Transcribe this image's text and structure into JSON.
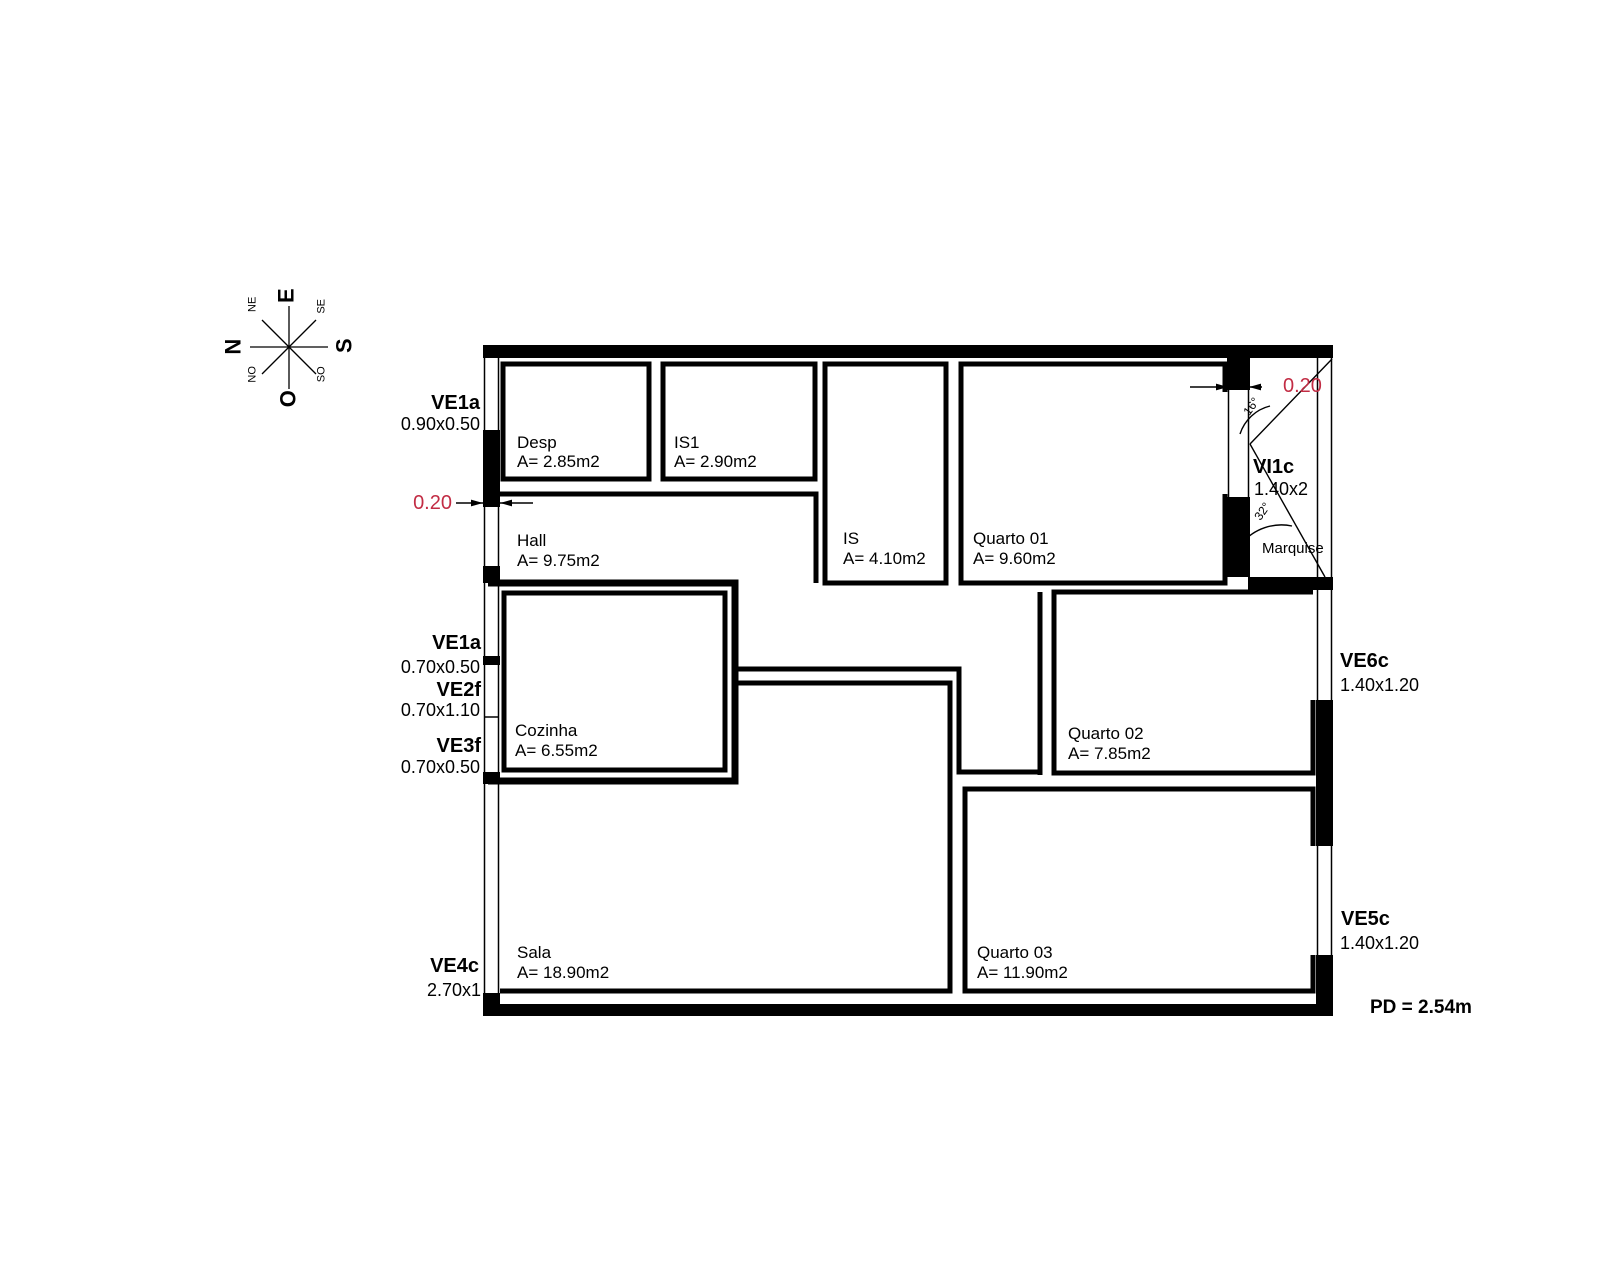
{
  "compass": {
    "n": "N",
    "e": "E",
    "s": "S",
    "o": "O",
    "ne": "NE",
    "se": "SE",
    "so": "SO",
    "no": "NO"
  },
  "rooms": {
    "desp": {
      "name": "Desp",
      "area": "A= 2.85m2"
    },
    "is1": {
      "name": "IS1",
      "area": "A= 2.90m2"
    },
    "is": {
      "name": "IS",
      "area": "A= 4.10m2"
    },
    "quarto01": {
      "name": "Quarto 01",
      "area": "A= 9.60m2"
    },
    "hall": {
      "name": "Hall",
      "area": "A= 9.75m2"
    },
    "cozinha": {
      "name": "Cozinha",
      "area": "A= 6.55m2"
    },
    "quarto02": {
      "name": "Quarto 02",
      "area": "A= 7.85m2"
    },
    "sala": {
      "name": "Sala",
      "area": "A= 18.90m2"
    },
    "quarto03": {
      "name": "Quarto 03",
      "area": "A= 11.90m2"
    },
    "marquise": {
      "name": "Marquise"
    }
  },
  "openings": {
    "ve1a_090": {
      "code": "VE1a",
      "size": "0.90x0.50"
    },
    "ve1a_070": {
      "code": "VE1a",
      "size": "0.70x0.50"
    },
    "ve2f": {
      "code": "VE2f",
      "size": "0.70x1.10"
    },
    "ve3f": {
      "code": "VE3f",
      "size": "0.70x0.50"
    },
    "ve4c": {
      "code": "VE4c",
      "size": "2.70x1"
    },
    "vi1c": {
      "code": "VI1c",
      "size": "1.40x2"
    },
    "ve6c": {
      "code": "VE6c",
      "size": "1.40x1.20"
    },
    "ve5c": {
      "code": "VE5c",
      "size": "1.40x1.20"
    }
  },
  "dimensions": {
    "left_wall_thickness": "0.20",
    "right_wall_thickness": "0.20"
  },
  "angles": {
    "marquise_upper": "16°",
    "marquise_lower": "32°"
  },
  "notes": {
    "ceiling_height": "PD = 2.54m"
  },
  "colors": {
    "dimension_text": "#c22c44",
    "drawing": "#000000",
    "background": "#ffffff"
  }
}
